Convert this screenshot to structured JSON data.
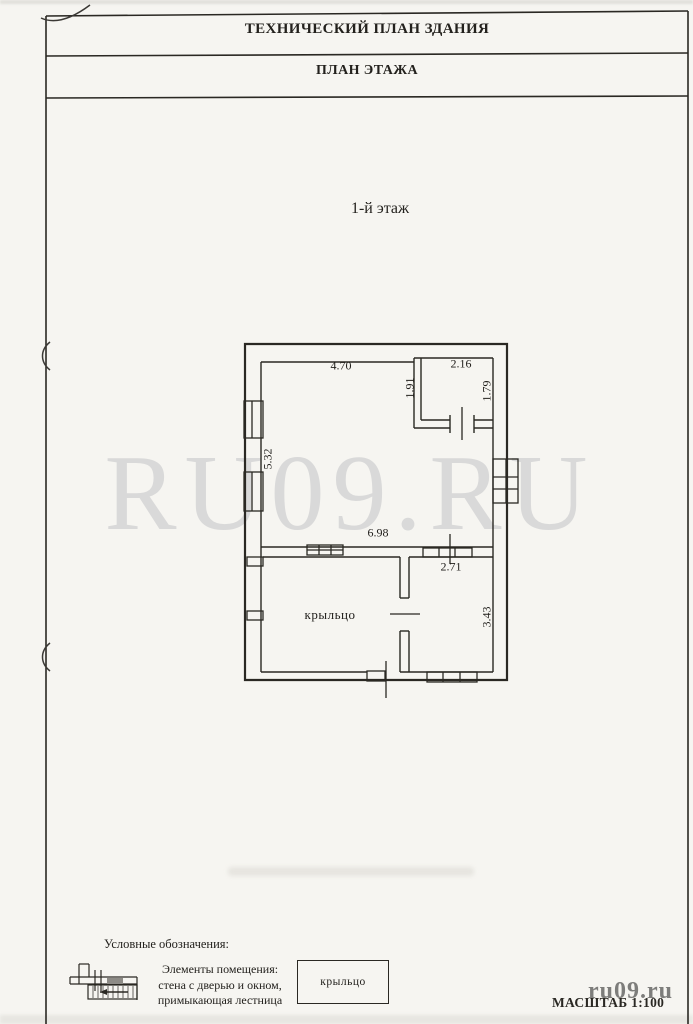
{
  "document": {
    "title": "ТЕХНИЧЕСКИЙ ПЛАН ЗДАНИЯ",
    "subtitle": "ПЛАН ЭТАЖА",
    "floor_label": "1-й этаж",
    "scale_label": "МАСШТАБ 1:100"
  },
  "watermark": {
    "center_text": "RU09.RU",
    "corner_text": "ru09.ru",
    "color": "#d9d9d9"
  },
  "floor_plan": {
    "room_label": "крыльцо",
    "dimensions": {
      "main_room_top": "4.70",
      "small_room_top": "2.16",
      "small_room_left": "1.91",
      "small_room_right": "1.79",
      "main_room_left": "5.32",
      "main_room_bottom": "6.98",
      "lower_room_top": "2.71",
      "lower_room_right": "3.43"
    }
  },
  "legend": {
    "heading": "Условные обозначения:",
    "description_lines": [
      "Элементы помещения:",
      "стена с дверью и окном,",
      "примыкающая лестница"
    ],
    "box_label": "крыльцо"
  },
  "colors": {
    "ink": "#2a2823",
    "paper": "#f6f5f1",
    "watermark_gray": "#d9d9d9"
  }
}
